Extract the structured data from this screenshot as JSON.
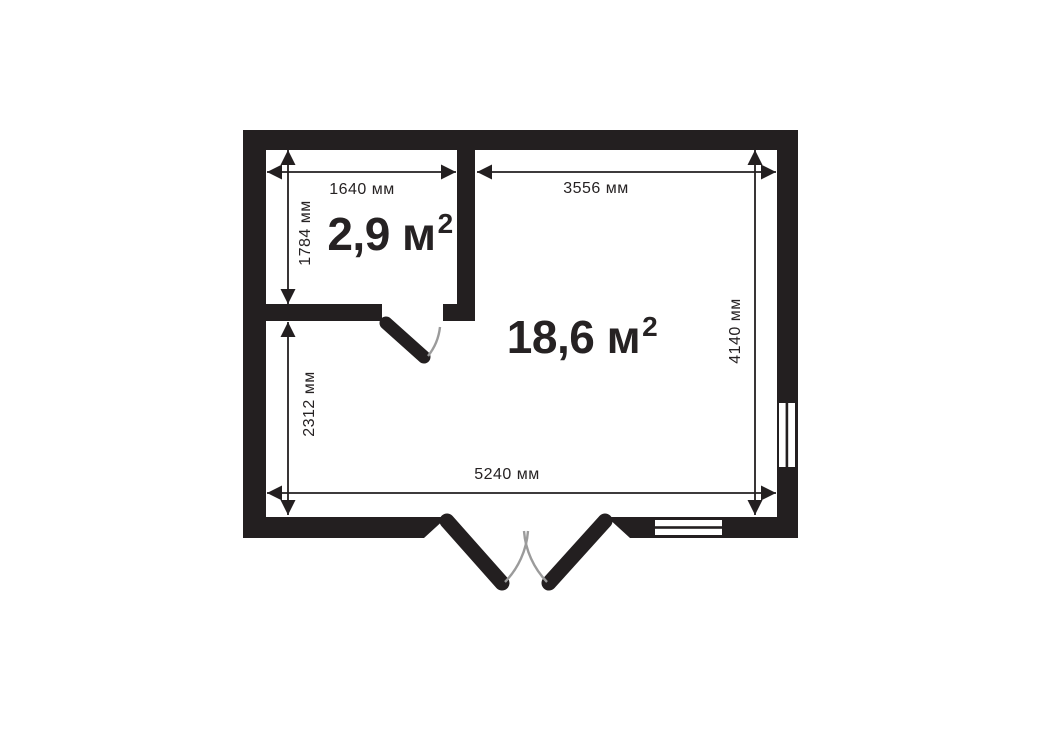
{
  "colors": {
    "wall": "#231f20",
    "text": "#262223",
    "arc": "#9b9b9b",
    "bg": "#ffffff"
  },
  "rooms": {
    "small": {
      "area": "2,9 м",
      "exponent": "2"
    },
    "main": {
      "area": "18,6 м",
      "exponent": "2"
    }
  },
  "dimensions": {
    "small_width": "1640 мм",
    "small_depth": "1784 мм",
    "main_width": "3556 мм",
    "main_depth": "4140 мм",
    "lower_depth": "2312 мм",
    "total_width": "5240 мм"
  }
}
